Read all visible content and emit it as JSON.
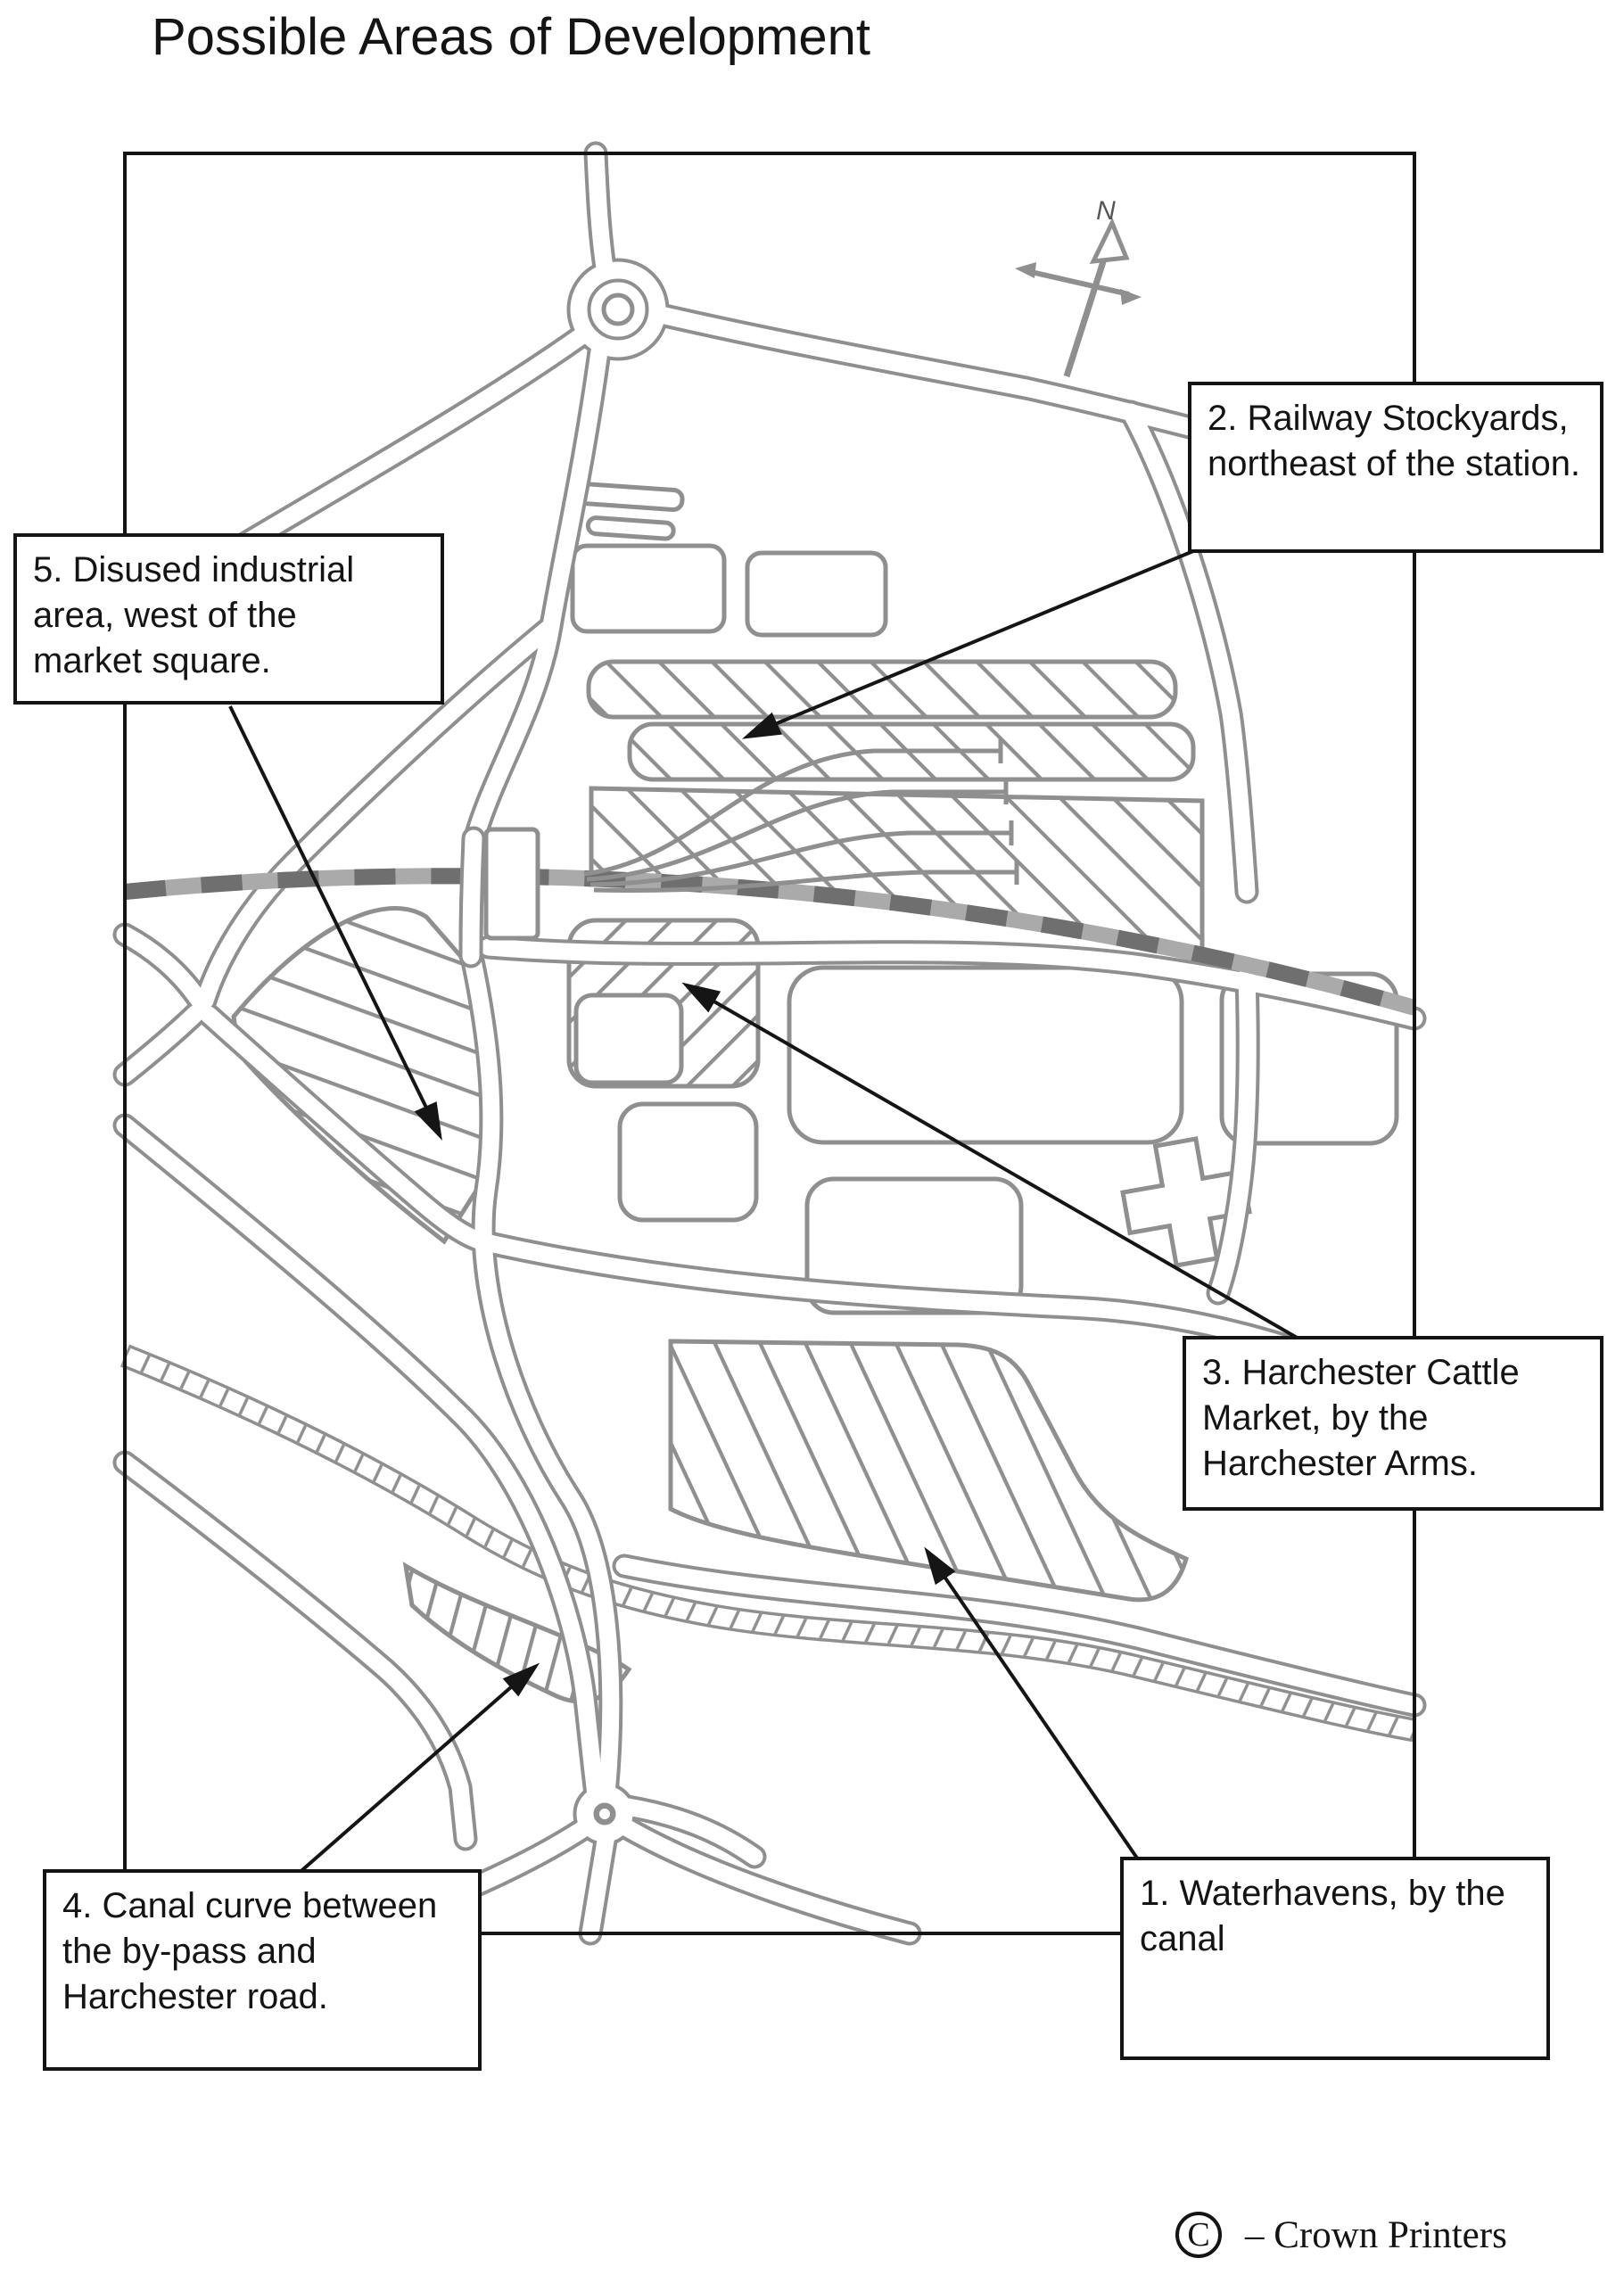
{
  "page": {
    "title": "Possible Areas of Development"
  },
  "map": {
    "compass": {
      "label": "N"
    },
    "colors": {
      "sketch_gray": "#8f8f8f",
      "railway_dash": "#6f6f6f",
      "ink_black": "#141414"
    }
  },
  "annotations": [
    {
      "id": 1,
      "label": "1. Waterhavens, by the\ncanal"
    },
    {
      "id": 2,
      "label": "2. Railway Stockyards,\nnortheast of the station."
    },
    {
      "id": 3,
      "label": "3. Harchester Cattle\nMarket, by the\nHarchester Arms."
    },
    {
      "id": 4,
      "label": "4. Canal curve between\nthe by-pass and\nHarchester road."
    },
    {
      "id": 5,
      "label": "5. Disused industrial\narea, west of the\nmarket square."
    }
  ],
  "footer": {
    "copyright_symbol": "C",
    "credit": "– Crown Printers"
  }
}
